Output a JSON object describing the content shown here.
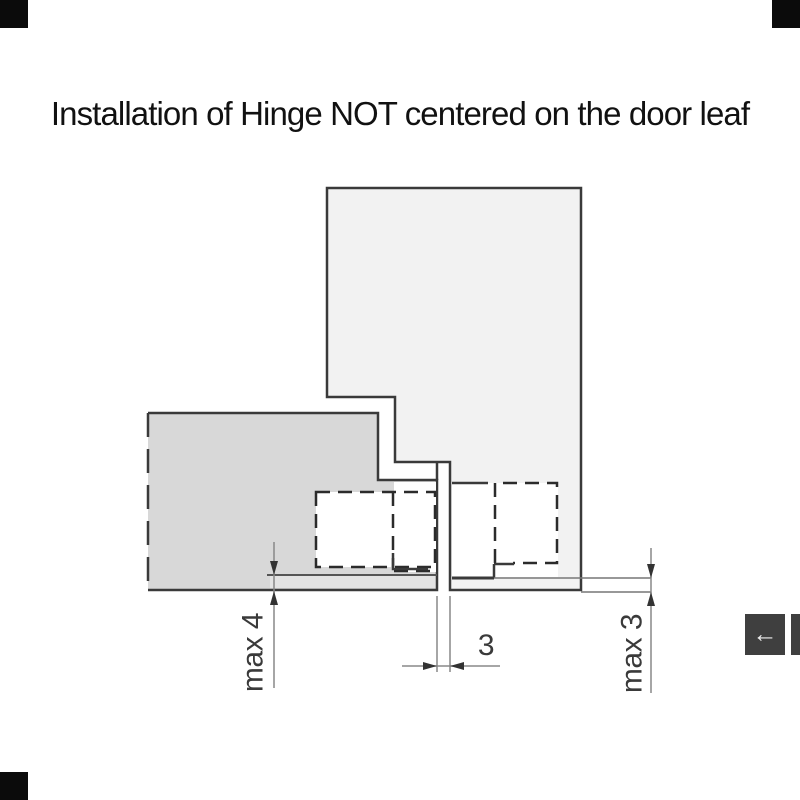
{
  "title": {
    "text": "Installation of Hinge NOT centered on the door leaf"
  },
  "diagram": {
    "dimensions": {
      "max4": {
        "label": "max 4"
      },
      "gap3": {
        "label": "3"
      },
      "max3": {
        "label": "max 3"
      }
    },
    "colors": {
      "left_leaf_fill": "#d8d8d8",
      "left_leaf_strip": "#e3e3e3",
      "right_leaf_fill": "#f2f2f2",
      "outline": "#3a3a3a",
      "dash": "#2b2b2b",
      "dim_line": "#888888",
      "ref_line": "#555555",
      "arrow": "#333333",
      "label_text": "#3a3a3a"
    }
  },
  "viewer": {
    "prev_button": {
      "glyph": "←",
      "icon": "left-arrow-icon",
      "background": "#3f3f3f",
      "glyph_color": "#ededed"
    },
    "next_button": {
      "background": "#3f3f3f"
    }
  },
  "markers": {
    "color": "#0b0b0b"
  }
}
